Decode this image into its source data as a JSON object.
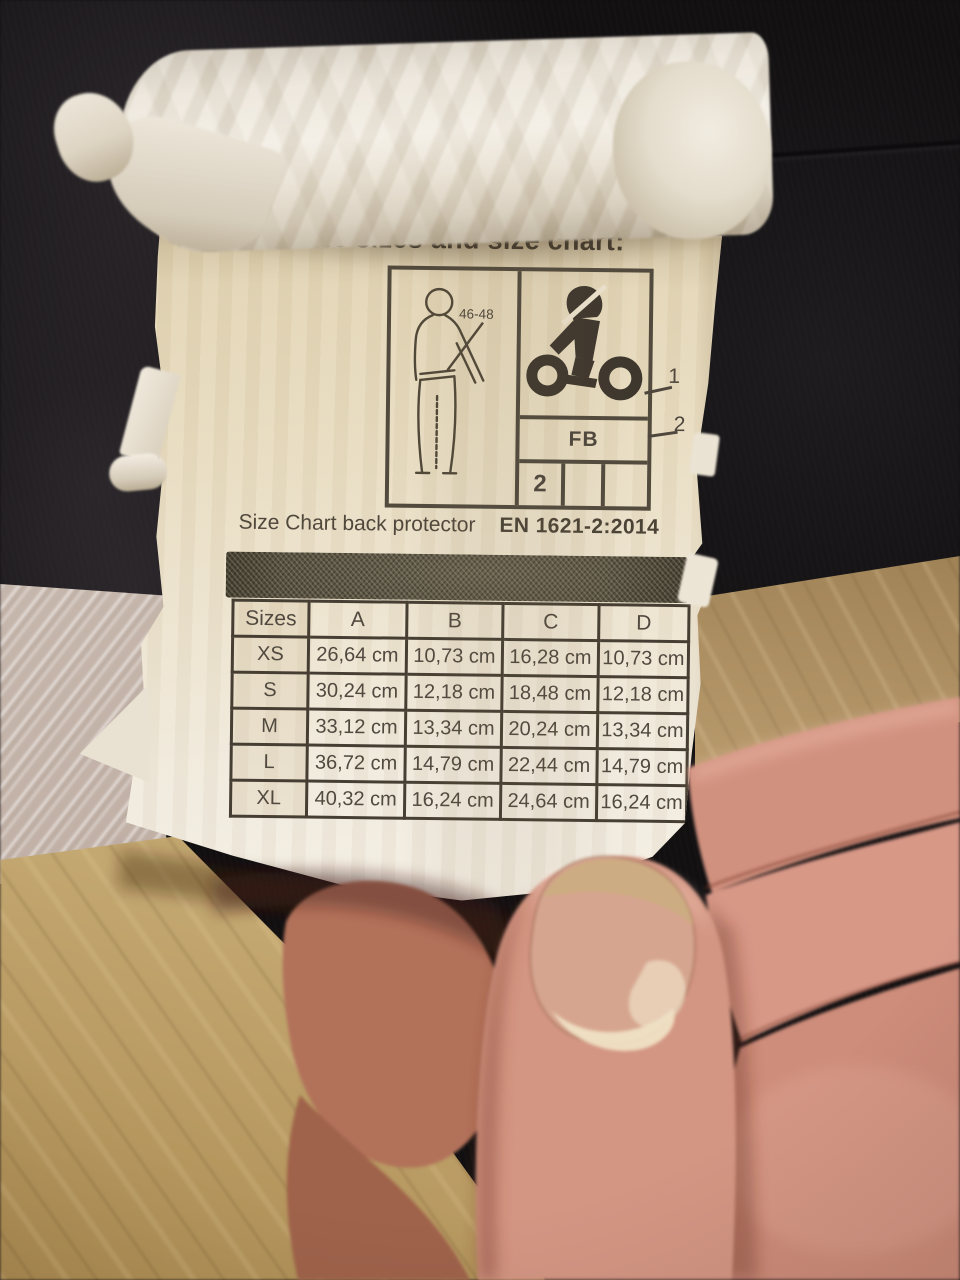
{
  "scene": {
    "description": "Photo of a hand holding a folded white fabric tag with a motorcycle back-protector size chart, over black garment fabric and a wooden floor",
    "palette": {
      "label_cream": "#e9dfc6",
      "print_ink": "#464033",
      "mesh_band": "#514c3d",
      "fabric_black": "#0a090c",
      "wood": "#ab8a58",
      "bubble_wrap": "#c9bdb4",
      "skin": "#d2907f",
      "nail": "#d9b694"
    }
  },
  "tag": {
    "heading": "Available sizes and size chart:",
    "pictogram": {
      "size_range": "46-48",
      "type_code": "FB",
      "level": "2",
      "callout_1": "1",
      "callout_2": "2"
    },
    "size_chart": {
      "title": "Size Chart back protector",
      "standard": "EN 1621-2:2014",
      "headers": [
        "Sizes",
        "A",
        "B",
        "C",
        "D"
      ],
      "rows": [
        {
          "size": "XS",
          "a": "26,64 cm",
          "b": "10,73 cm",
          "c": "16,28 cm",
          "d": "10,73 cm"
        },
        {
          "size": "S",
          "a": "30,24 cm",
          "b": "12,18 cm",
          "c": "18,48 cm",
          "d": "12,18 cm"
        },
        {
          "size": "M",
          "a": "33,12 cm",
          "b": "13,34 cm",
          "c": "20,24 cm",
          "d": "13,34 cm"
        },
        {
          "size": "L",
          "a": "36,72 cm",
          "b": "14,79 cm",
          "c": "22,44 cm",
          "d": "14,79 cm"
        },
        {
          "size": "XL",
          "a": "40,32 cm",
          "b": "16,24 cm",
          "c": "24,64 cm",
          "d": "16,24 cm"
        }
      ]
    }
  }
}
